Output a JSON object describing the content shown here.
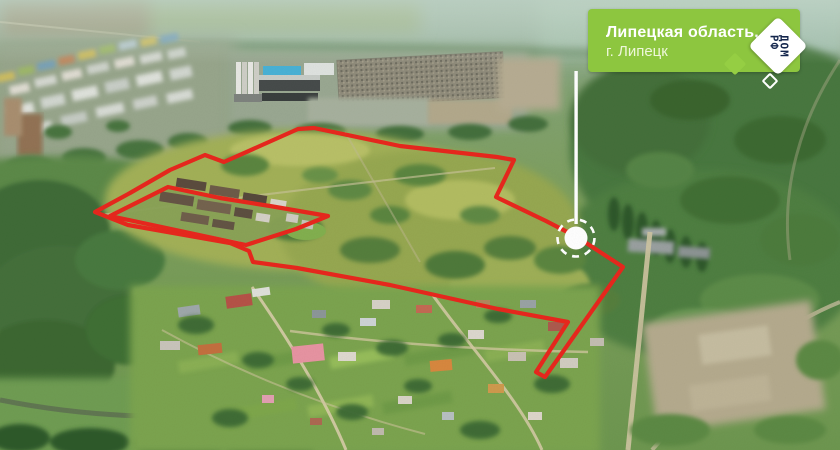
{
  "banner": {
    "region_line": "Липецкая область,",
    "city_line": "г. Липецк"
  },
  "logo": {
    "word_top": "ДОМ",
    "word_bottom": "РФ"
  },
  "colors": {
    "banner_green": "#8dc63f",
    "logo_navy": "#13254c",
    "boundary_red": "#e8281e",
    "marker_white": "#ffffff"
  }
}
